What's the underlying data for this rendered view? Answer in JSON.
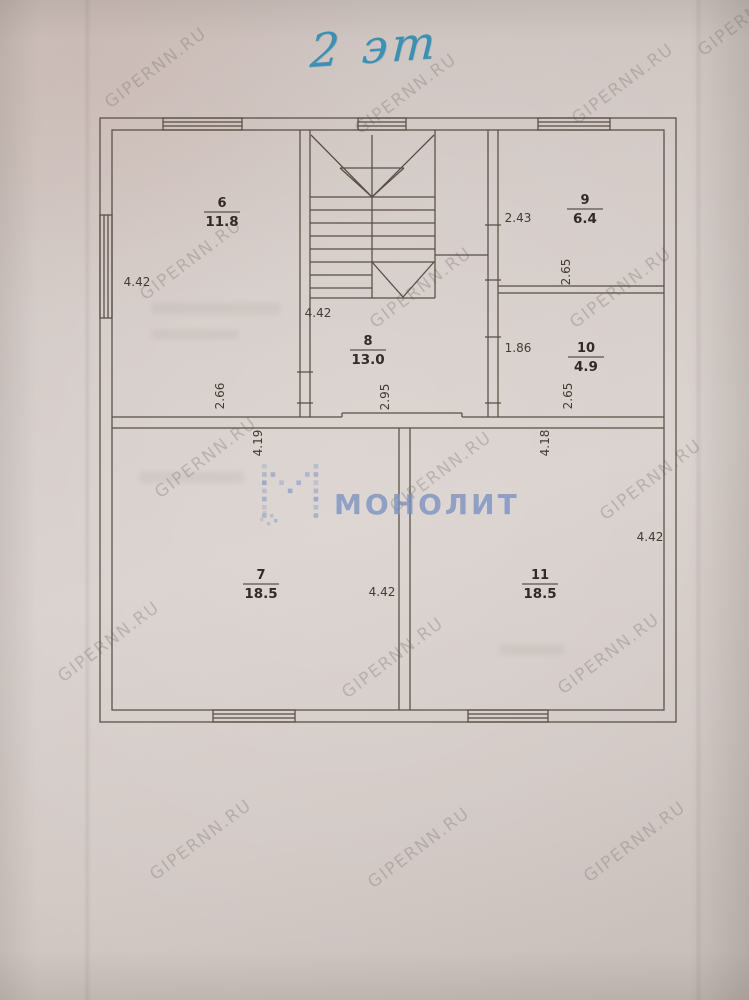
{
  "photo": {
    "floor_label": "2 эт",
    "watermark_text": "GIPERNN.RU",
    "logo_text": "МОНОЛИТ",
    "logo_color": "#7b90c1",
    "ink_color": "#3d90b2",
    "line_color": "#584e45"
  },
  "plan": {
    "rooms": {
      "r6": {
        "number": "6",
        "area": "11.8"
      },
      "r7": {
        "number": "7",
        "area": "18.5"
      },
      "r8": {
        "number": "8",
        "area": "13.0"
      },
      "r9": {
        "number": "9",
        "area": "6.4"
      },
      "r10": {
        "number": "10",
        "area": "4.9"
      },
      "r11": {
        "number": "11",
        "area": "18.5"
      }
    },
    "dims": {
      "room6_left": "4.42",
      "room6_bottom": "2.66",
      "hall_top": "4.42",
      "hall_bottom": "2.95",
      "room9_left": "2.43",
      "room9_right": "2.65",
      "room10_left": "1.86",
      "room10_right": "2.65",
      "room7_top": "4.19",
      "room7_mid": "4.42",
      "room11_top": "4.18",
      "room11_right": "4.42"
    }
  }
}
